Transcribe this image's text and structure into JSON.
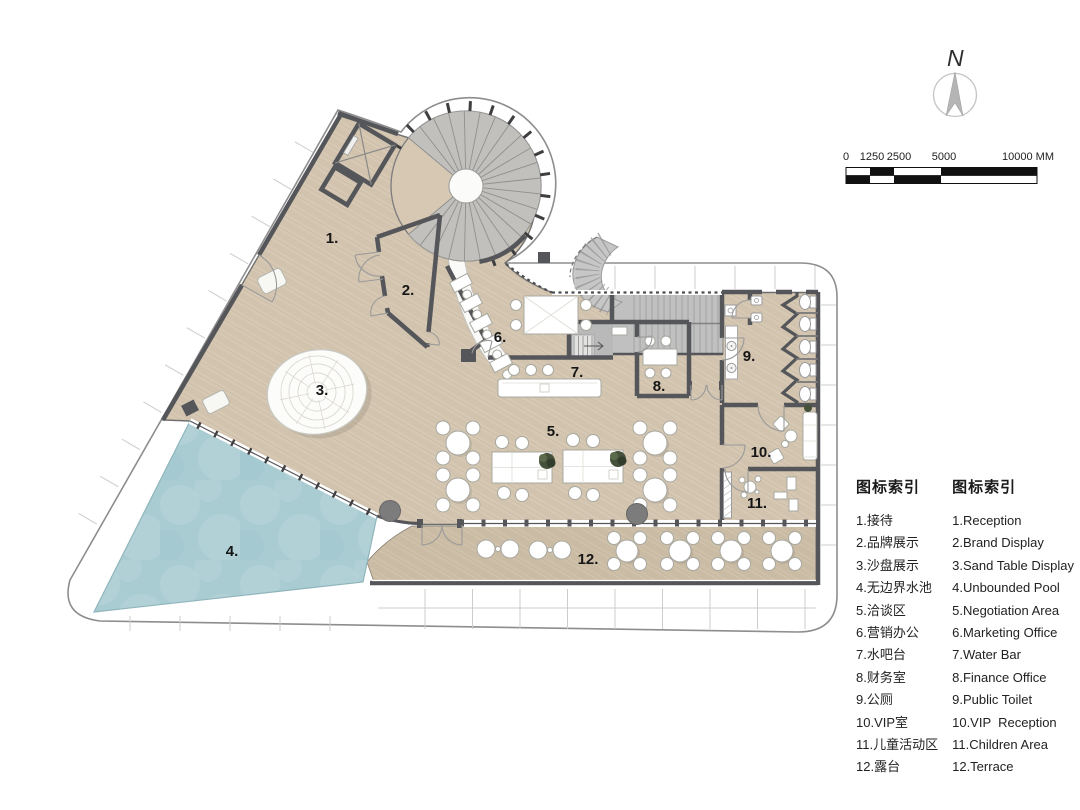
{
  "plan": {
    "room_labels": [
      {
        "label": "1."
      },
      {
        "label": "2."
      },
      {
        "label": "3."
      },
      {
        "label": "4."
      },
      {
        "label": "5."
      },
      {
        "label": "6."
      },
      {
        "label": "7."
      },
      {
        "label": "8."
      },
      {
        "label": "9."
      },
      {
        "label": "10."
      },
      {
        "label": "11."
      },
      {
        "label": "12."
      }
    ]
  },
  "north_arrow": {
    "label": "N"
  },
  "scale_bar": {
    "ticks": [
      "0",
      "1250",
      "2500",
      "5000",
      "10000 MM"
    ]
  },
  "legend": {
    "title_zh": "图标索引",
    "title_en": "图标索引",
    "items": [
      {
        "zh": "1.接待",
        "en": "1.Reception"
      },
      {
        "zh": "2.品牌展示",
        "en": "2.Brand Display"
      },
      {
        "zh": "3.沙盘展示",
        "en": "3.Sand Table Display"
      },
      {
        "zh": "4.无边界水池",
        "en": "4.Unbounded Pool"
      },
      {
        "zh": "5.洽谈区",
        "en": "5.Negotiation Area"
      },
      {
        "zh": "6.营销办公",
        "en": "6.Marketing Office"
      },
      {
        "zh": "7.水吧台",
        "en": "7.Water Bar"
      },
      {
        "zh": "8.财务室",
        "en": "8.Finance Office"
      },
      {
        "zh": "9.公厕",
        "en": "9.Public Toilet"
      },
      {
        "zh": "10.VIP室",
        "en": "10.VIP  Reception"
      },
      {
        "zh": "11.儿童活动区",
        "en": "11.Children Area"
      },
      {
        "zh": "12.露台",
        "en": "12.Terrace"
      }
    ]
  },
  "colors": {
    "floor": "#d6c8b3",
    "terrace": "#cfc0a9",
    "pool": "#a9ccd2",
    "wall": "#55565a",
    "stair": "#c0c0c0",
    "band_line": "#8d8d8d",
    "label": "#161616"
  }
}
